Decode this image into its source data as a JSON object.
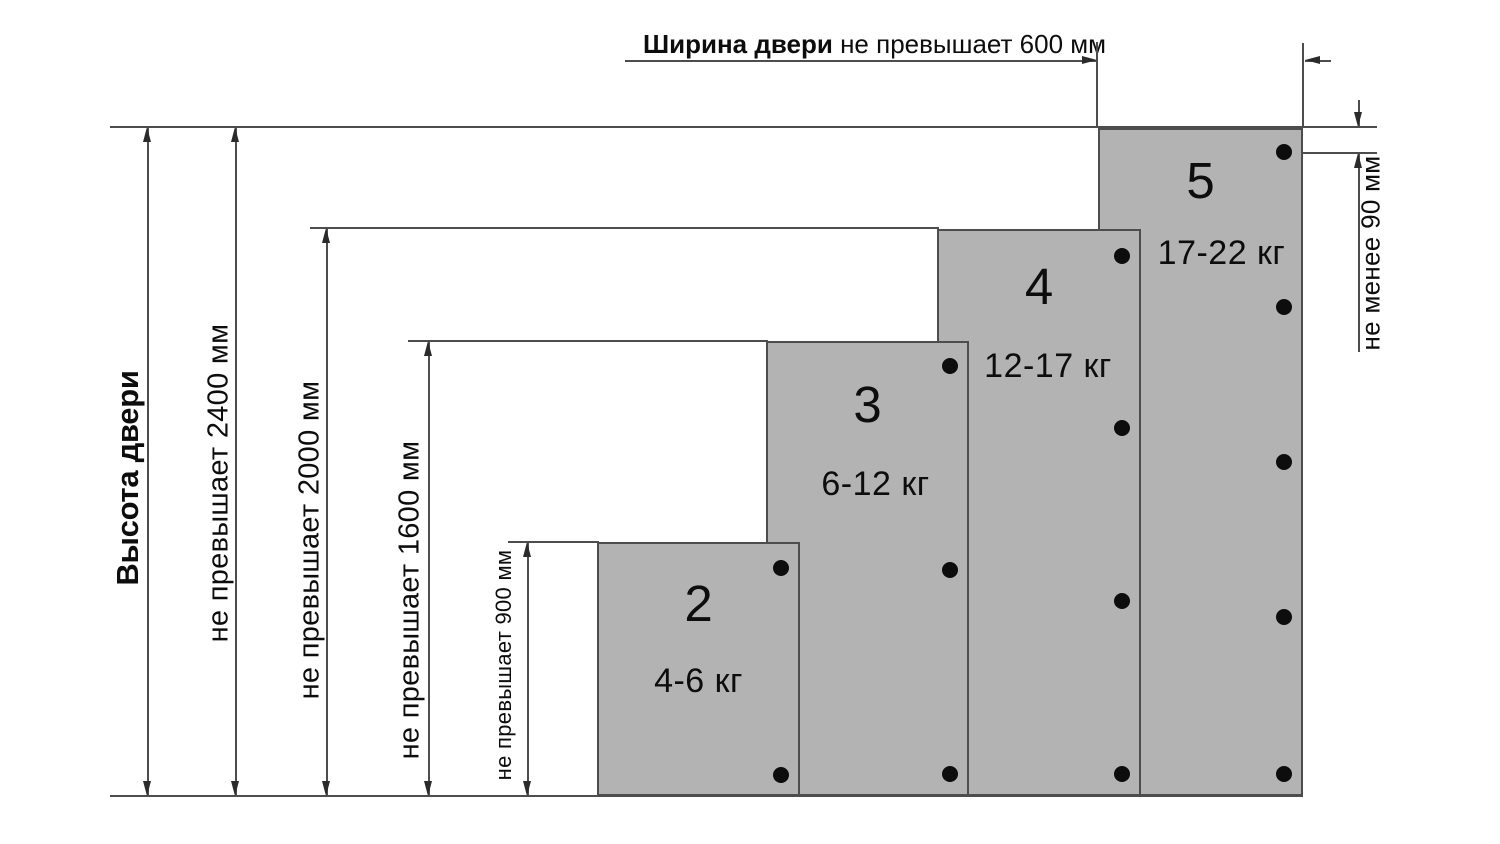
{
  "diagram_title": "Door height / hinge count diagram",
  "width_dimension": {
    "label_bold": "Ширина двери",
    "label_rest": " не превышает 600 мм"
  },
  "height_axis_label": "Высота двери",
  "height_limits": [
    "не превышает 2400 мм",
    "не превышает 2000 мм",
    "не превышает 1600 мм",
    "не превышает 900 мм"
  ],
  "hinge_gap_label": "не менее 90 мм",
  "doors": [
    {
      "number": "2",
      "weight": "4-6 кг",
      "hinges": 2,
      "hinge_offsets_px": [
        26,
        233
      ]
    },
    {
      "number": "3",
      "weight": "6-12 кг",
      "hinges": 3,
      "hinge_offsets_px": [
        25,
        229,
        433
      ]
    },
    {
      "number": "4",
      "weight": "12-17 кг",
      "hinges": 4,
      "hinge_offsets_px": [
        27,
        199,
        372,
        545
      ]
    },
    {
      "number": "5",
      "weight": "17-22 кг",
      "hinges": 5,
      "hinge_offsets_px": [
        24,
        179,
        334,
        489,
        646
      ]
    }
  ],
  "colors": {
    "background": "#ffffff",
    "door_fill": "#b3b3b3",
    "door_border": "#4d4d4d",
    "dimension_line": "#4d4d4d",
    "arrowhead": "#2b2b2b",
    "text": "#0d0d0d",
    "hinge_dot": "#0d0d0d"
  }
}
